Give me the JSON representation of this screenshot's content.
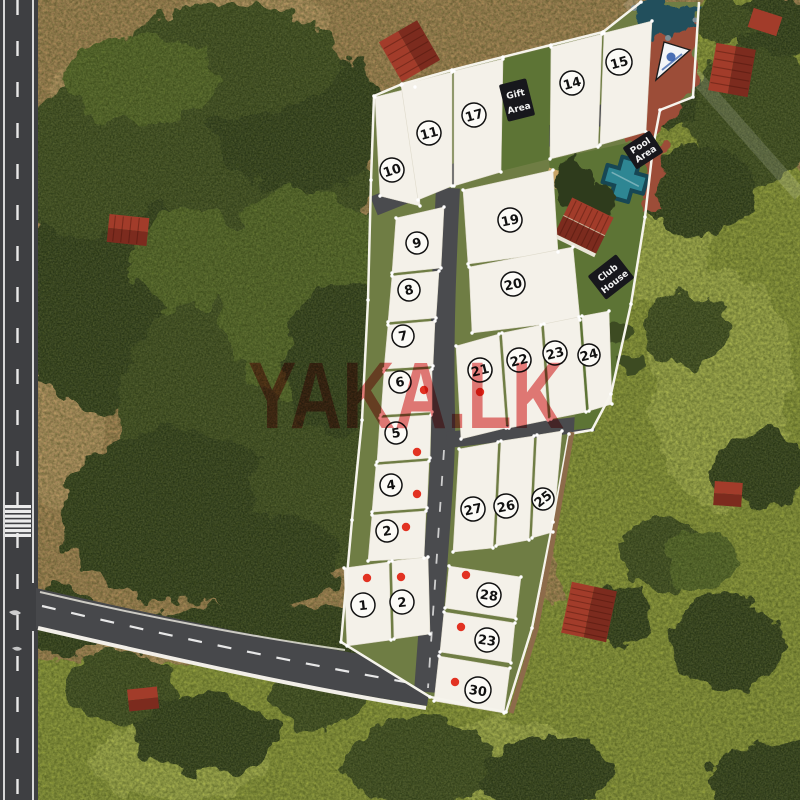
{
  "site": {
    "watermark": {
      "text": "YAKA.LK"
    },
    "palette": {
      "dirt": "#b2895c",
      "dirtL": "#c59b6b",
      "tree": "#3c4b24",
      "treeD": "#2e3b1d",
      "treeL": "#55682c",
      "grass": "#94a03d",
      "grassL": "#aeb851",
      "road": "#47484b",
      "roadL": "#3e3f42",
      "devgreen": "#6f7d44",
      "lawn": "#5d7435",
      "redpath": "#9c4e37",
      "pond": "#24505c",
      "pool": "#2e8693",
      "poolD": "#174754",
      "roof": "#a23c2a",
      "roofD": "#7c2b1e",
      "fence": "#f6f4ec",
      "wall": "#8d6b4a",
      "plot": "#f4f1e9",
      "sign": "#17171c",
      "dot": "#e23222",
      "wm": "#e25a5a"
    },
    "plots": [
      {
        "label": "10",
        "num": [
          392,
          170
        ],
        "r": 12,
        "rot": -18,
        "quad": [
          [
            375,
            97
          ],
          [
            415,
            87
          ],
          [
            420,
            206
          ],
          [
            380,
            196
          ]
        ]
      },
      {
        "label": "11",
        "num": [
          429,
          133
        ],
        "r": 12,
        "rot": -15,
        "quad": [
          [
            401,
            85
          ],
          [
            452,
            72
          ],
          [
            452,
            186
          ],
          [
            418,
            200
          ]
        ]
      },
      {
        "label": "17",
        "num": [
          474,
          115
        ],
        "r": 12,
        "rot": -15,
        "quad": [
          [
            454,
            71
          ],
          [
            503,
            59
          ],
          [
            501,
            172
          ],
          [
            454,
            186
          ]
        ]
      },
      {
        "label": "14",
        "num": [
          572,
          83
        ],
        "r": 12,
        "rot": -15,
        "quad": [
          [
            551,
            47
          ],
          [
            602,
            34
          ],
          [
            598,
            147
          ],
          [
            550,
            159
          ]
        ]
      },
      {
        "label": "15",
        "num": [
          619,
          62
        ],
        "r": 13,
        "rot": -15,
        "quad": [
          [
            604,
            33
          ],
          [
            652,
            21
          ],
          [
            646,
            132
          ],
          [
            600,
            145
          ]
        ]
      },
      {
        "label": "19",
        "num": [
          510,
          220
        ],
        "r": 12,
        "rot": -12,
        "quad": [
          [
            463,
            190
          ],
          [
            553,
            170
          ],
          [
            558,
            252
          ],
          [
            468,
            264
          ]
        ]
      },
      {
        "label": "20",
        "num": [
          513,
          284
        ],
        "r": 12,
        "rot": -12,
        "quad": [
          [
            469,
            267
          ],
          [
            573,
            247
          ],
          [
            580,
            320
          ],
          [
            472,
            333
          ]
        ]
      },
      {
        "label": "9",
        "num": [
          417,
          243
        ],
        "r": 11,
        "rot": -14,
        "quad": [
          [
            396,
            218
          ],
          [
            444,
            207
          ],
          [
            441,
            268
          ],
          [
            392,
            273
          ]
        ]
      },
      {
        "label": "8",
        "num": [
          409,
          290
        ],
        "r": 11,
        "rot": -14,
        "quad": [
          [
            392,
            276
          ],
          [
            439,
            271
          ],
          [
            436,
            318
          ],
          [
            388,
            322
          ]
        ]
      },
      {
        "label": "7",
        "num": [
          403,
          336
        ],
        "r": 11,
        "rot": -10,
        "quad": [
          [
            388,
            325
          ],
          [
            435,
            321
          ],
          [
            433,
            366
          ],
          [
            384,
            369
          ]
        ]
      },
      {
        "label": "6",
        "num": [
          400,
          382
        ],
        "r": 11,
        "rot": -10,
        "dot": [
          424,
          390
        ],
        "quad": [
          [
            384,
            372
          ],
          [
            432,
            369
          ],
          [
            432,
            412
          ],
          [
            381,
            415
          ]
        ]
      },
      {
        "label": "5",
        "num": [
          396,
          433
        ],
        "r": 11,
        "rot": -8,
        "dot": [
          417,
          452
        ],
        "quad": [
          [
            380,
            418
          ],
          [
            431,
            415
          ],
          [
            430,
            458
          ],
          [
            377,
            462
          ]
        ]
      },
      {
        "label": "4",
        "num": [
          391,
          485
        ],
        "r": 11,
        "rot": -8,
        "dot": [
          417,
          494
        ],
        "quad": [
          [
            376,
            465
          ],
          [
            429,
            461
          ],
          [
            427,
            508
          ],
          [
            372,
            512
          ]
        ]
      },
      {
        "label": "2",
        "num": [
          387,
          531
        ],
        "r": 11,
        "rot": -8,
        "dot": [
          406,
          527
        ],
        "quad": [
          [
            372,
            515
          ],
          [
            426,
            511
          ],
          [
            424,
            558
          ],
          [
            368,
            561
          ]
        ]
      },
      {
        "label": "1",
        "num": [
          363,
          605
        ],
        "r": 12,
        "rot": -6,
        "dot": [
          367,
          578
        ],
        "quad": [
          [
            344,
            568
          ],
          [
            389,
            562
          ],
          [
            391,
            640
          ],
          [
            347,
            646
          ]
        ]
      },
      {
        "label": "2",
        "num": [
          402,
          602
        ],
        "r": 12,
        "rot": -6,
        "dot": [
          401,
          577
        ],
        "quad": [
          [
            392,
            561
          ],
          [
            428,
            557
          ],
          [
            430,
            634
          ],
          [
            394,
            639
          ]
        ]
      },
      {
        "label": "21",
        "num": [
          480,
          370
        ],
        "r": 12,
        "rot": -14,
        "dot": [
          480,
          392
        ],
        "quad": [
          [
            456,
            346
          ],
          [
            499,
            334
          ],
          [
            506,
            428
          ],
          [
            461,
            439
          ]
        ]
      },
      {
        "label": "22",
        "num": [
          519,
          360
        ],
        "r": 12,
        "rot": -14,
        "quad": [
          [
            502,
            333
          ],
          [
            541,
            325
          ],
          [
            548,
            420
          ],
          [
            509,
            428
          ]
        ]
      },
      {
        "label": "23",
        "num": [
          555,
          353
        ],
        "r": 12,
        "rot": -14,
        "quad": [
          [
            544,
            324
          ],
          [
            579,
            317
          ],
          [
            586,
            412
          ],
          [
            551,
            419
          ]
        ]
      },
      {
        "label": "24",
        "num": [
          589,
          355
        ],
        "r": 11,
        "rot": -14,
        "quad": [
          [
            582,
            316
          ],
          [
            609,
            311
          ],
          [
            612,
            404
          ],
          [
            589,
            411
          ]
        ]
      },
      {
        "label": "27",
        "num": [
          473,
          509
        ],
        "r": 12,
        "rot": -12,
        "quad": [
          [
            459,
            449
          ],
          [
            498,
            442
          ],
          [
            493,
            548
          ],
          [
            453,
            552
          ]
        ]
      },
      {
        "label": "26",
        "num": [
          506,
          506
        ],
        "r": 12,
        "rot": -12,
        "quad": [
          [
            501,
            441
          ],
          [
            534,
            436
          ],
          [
            529,
            540
          ],
          [
            496,
            546
          ]
        ]
      },
      {
        "label": "25",
        "num": [
          543,
          499
        ],
        "r": 11,
        "rot": -38,
        "quad": [
          [
            537,
            435
          ],
          [
            562,
            431
          ],
          [
            553,
            532
          ],
          [
            532,
            538
          ]
        ]
      },
      {
        "label": "28",
        "num": [
          489,
          595
        ],
        "r": 12,
        "rot": 8,
        "dot": [
          466,
          575
        ],
        "quad": [
          [
            449,
            566
          ],
          [
            521,
            577
          ],
          [
            516,
            619
          ],
          [
            445,
            608
          ]
        ]
      },
      {
        "label": "23",
        "num": [
          487,
          640
        ],
        "r": 12,
        "rot": 8,
        "dot": [
          461,
          627
        ],
        "quad": [
          [
            444,
            612
          ],
          [
            515,
            623
          ],
          [
            511,
            663
          ],
          [
            440,
            652
          ]
        ]
      },
      {
        "label": "30",
        "num": [
          478,
          690
        ],
        "r": 13,
        "rot": 8,
        "dot": [
          455,
          682
        ],
        "quad": [
          [
            439,
            656
          ],
          [
            510,
            668
          ],
          [
            504,
            713
          ],
          [
            434,
            701
          ]
        ]
      }
    ],
    "green_plot": {
      "quad": [
        [
          503,
          59
        ],
        [
          551,
          47
        ],
        [
          549,
          159
        ],
        [
          501,
          171
        ]
      ]
    },
    "signs": [
      {
        "name": "gift-area",
        "lines": [
          "Gift",
          "Area"
        ],
        "cx": 517,
        "cy": 100,
        "w": 28,
        "h": 38,
        "rot": -14
      },
      {
        "name": "pool-area",
        "lines": [
          "Pool",
          "Area"
        ],
        "cx": 643,
        "cy": 150,
        "w": 32,
        "h": 26,
        "rot": -33
      },
      {
        "name": "club-house",
        "lines": [
          "Club",
          "House"
        ],
        "cx": 611,
        "cy": 277,
        "w": 36,
        "h": 30,
        "rot": -38
      }
    ]
  }
}
